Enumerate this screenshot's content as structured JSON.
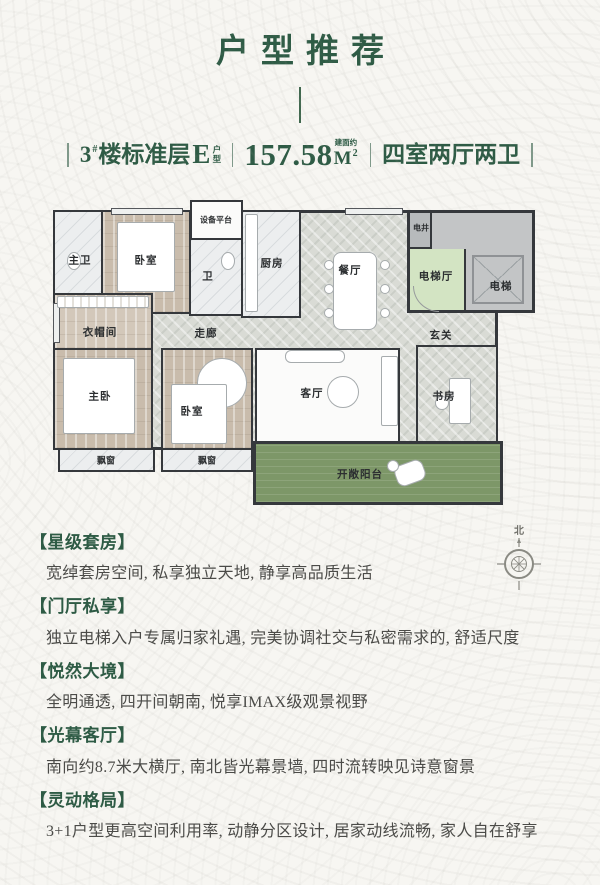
{
  "header": {
    "title": "户型推荐",
    "spec": {
      "building_num": "3",
      "building_sup": "#",
      "floor_text": "楼标准层",
      "unit_letter": "E",
      "unit_type_small": "户型",
      "area_value": "157.58",
      "area_unit": "M",
      "area_sup": "2",
      "area_note": "建面约",
      "rooms_text": "四室两厅两卫"
    }
  },
  "floorplan": {
    "compass_north": "北",
    "rooms": [
      {
        "label": "主卫"
      },
      {
        "label": "卧室"
      },
      {
        "label": "设备平台"
      },
      {
        "label": "卫"
      },
      {
        "label": "厨房"
      },
      {
        "label": "餐厅"
      },
      {
        "label": "电井"
      },
      {
        "label": "电梯厅"
      },
      {
        "label": "电梯"
      },
      {
        "label": "衣帽间"
      },
      {
        "label": "走廊"
      },
      {
        "label": "玄关"
      },
      {
        "label": "主卧"
      },
      {
        "label": "卧室"
      },
      {
        "label": "客厅"
      },
      {
        "label": "书房"
      },
      {
        "label": "飘窗"
      },
      {
        "label": "飘窗"
      },
      {
        "label": "开敞阳台"
      }
    ]
  },
  "sections": [
    {
      "heading": "【星级套房】",
      "body": "宽绰套房空间, 私享独立天地, 静享高品质生活"
    },
    {
      "heading": "【门厅私享】",
      "body": "独立电梯入户专属归家礼遇, 完美协调社交与私密需求的, 舒适尺度"
    },
    {
      "heading": "【悦然大境】",
      "body": "全明通透, 四开间朝南, 悦享IMAX级观景视野"
    },
    {
      "heading": "【光幕客厅】",
      "body": "南向约8.7米大横厅, 南北皆光幕景墙, 四时流转映见诗意窗景"
    },
    {
      "heading": "【灵动格局】",
      "body": "3+1户型更高空间利用率, 动静分区设计, 居家动线流畅, 家人自在舒享"
    }
  ],
  "colors": {
    "accent_green": "#2e5b45",
    "text_dark": "#4b4b48",
    "wall": "#35383c",
    "balcony_green": "#7d9768",
    "elevator_hall_green": "#d3e4c3",
    "wood_floor": "#c9bcac",
    "herringbone_floor": "#d9dbd5",
    "marble_floor": "#eceeef",
    "shaft_gray": "#c3c5c6"
  }
}
